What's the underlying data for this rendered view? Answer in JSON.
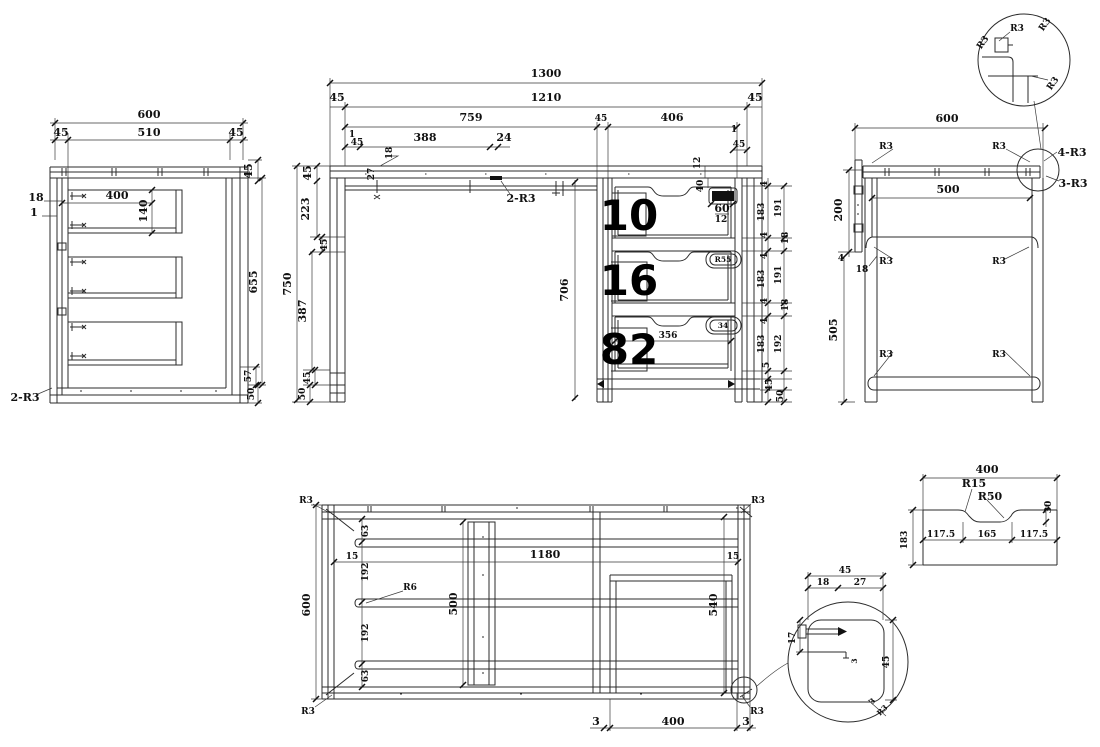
{
  "drawing_type": "furniture desk CAD multi-view drawing",
  "line_color": "#2b2b2b",
  "background": "#ffffff",
  "left_view": {
    "w600": "600",
    "m45l": "45",
    "w510": "510",
    "m45r": "45",
    "t45": "45",
    "d18": "18",
    "d1": "1",
    "d400": "400",
    "d140": "140",
    "h655": "655",
    "d57": "57",
    "d50": "50",
    "callout": "2-R3"
  },
  "front_view": {
    "w1300": "1300",
    "m45l": "45",
    "w1210": "1210",
    "m45r": "45",
    "w759": "759",
    "m45c": "45",
    "w406": "406",
    "s1l": "1",
    "s45l": "45",
    "d388": "388",
    "d24": "24",
    "r18": "18",
    "r27": "27",
    "callout": "2-R3",
    "s1r": "1",
    "s45r": "45",
    "r12": "12",
    "r40": "40",
    "h60": "60",
    "h12": "12",
    "c45t": "45",
    "c223": "223",
    "c45m": "45",
    "c750": "750",
    "c387": "387",
    "c45b": "45",
    "c50": "50",
    "c706": "706",
    "n1": "10",
    "n2": "16",
    "n3": "82",
    "d356": "356",
    "hl2": "R55",
    "hl3": "34",
    "right_col": [
      "4",
      "183",
      "191",
      "4",
      "18",
      "4",
      "183",
      "191",
      "4",
      "18",
      "4",
      "183",
      "192",
      "5",
      "45",
      "50"
    ]
  },
  "right_view": {
    "w600": "600",
    "w500": "500",
    "c200": "200",
    "c4": "4",
    "c18": "18",
    "c505": "505",
    "r3": "R3",
    "c4r3": "4-R3",
    "c3r3": "3-R3"
  },
  "corner_detail": {
    "r3": "R3"
  },
  "bottom_view": {
    "r3": "R3",
    "h600": "600",
    "c63a": "63",
    "c192a": "192",
    "c192b": "192",
    "c63b": "63",
    "i15l": "15",
    "w1180": "1180",
    "i15r": "15",
    "r6": "R6",
    "b500": "500",
    "o540": "540",
    "g3l": "3",
    "g400": "400",
    "g3r": "3"
  },
  "foot_detail": {
    "w45": "45",
    "d18": "18",
    "d27": "27",
    "d17": "17",
    "d3": "3",
    "h45": "45",
    "c3": "3",
    "cr3": "R3"
  },
  "groove_profile": {
    "w400": "400",
    "r15": "R15",
    "r50": "R50",
    "d30": "30",
    "s117l": "117.5",
    "s165": "165",
    "s117r": "117.5",
    "h183": "183"
  }
}
